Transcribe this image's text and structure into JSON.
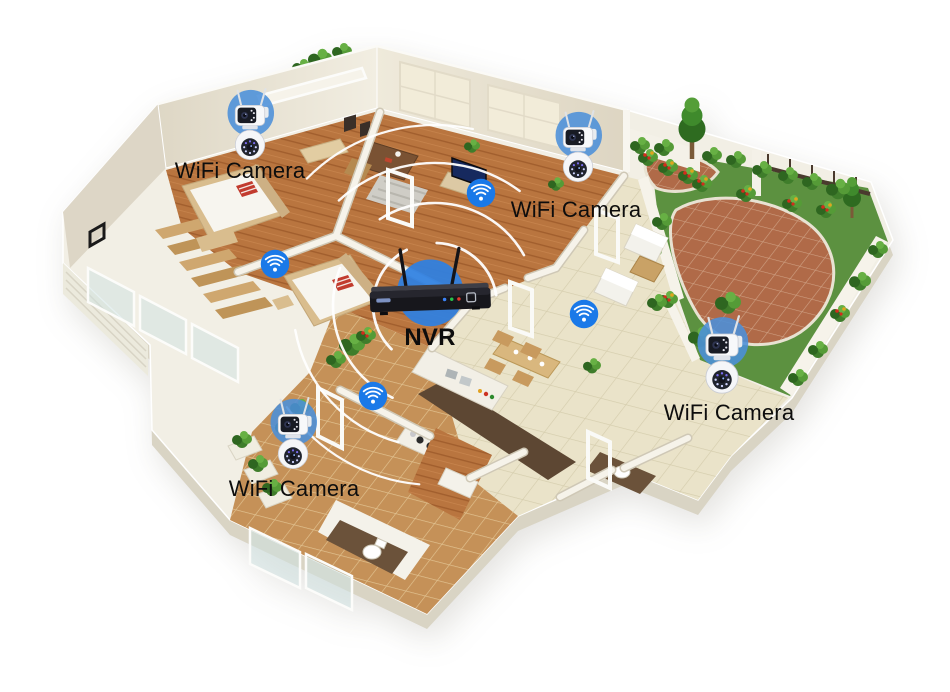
{
  "diagram": {
    "kind": "smart-home wifi camera coverage illustration",
    "background_color": "#ffffff"
  },
  "devices": {
    "nvr": {
      "label": "NVR"
    },
    "cameras": [
      {
        "label": "WiFi Camera"
      },
      {
        "label": "WiFi Camera"
      },
      {
        "label": "WiFi Camera"
      },
      {
        "label": "WiFi Camera"
      }
    ]
  },
  "icons": {
    "wifi_signal_icons": 4,
    "signal_ring_arcs": 4
  },
  "colors": {
    "wifi_icon_blue": "#1a79e8",
    "nvr_halo_blue": "#2e80e2",
    "camera_halo_blue": "#4b90da",
    "signal_ring_white": "#ffffff",
    "label_text": "#0d0d0d",
    "wall_white": "#f2efe5",
    "wood_floor": "#b9753f",
    "tile_floor": "#eae3c9",
    "garden_brick": "#b06a48",
    "garden_green": "#5c9140",
    "balcony_tan": "#c59158",
    "nvr_body_black": "#17171c",
    "accent_red": "#c23b2e"
  }
}
